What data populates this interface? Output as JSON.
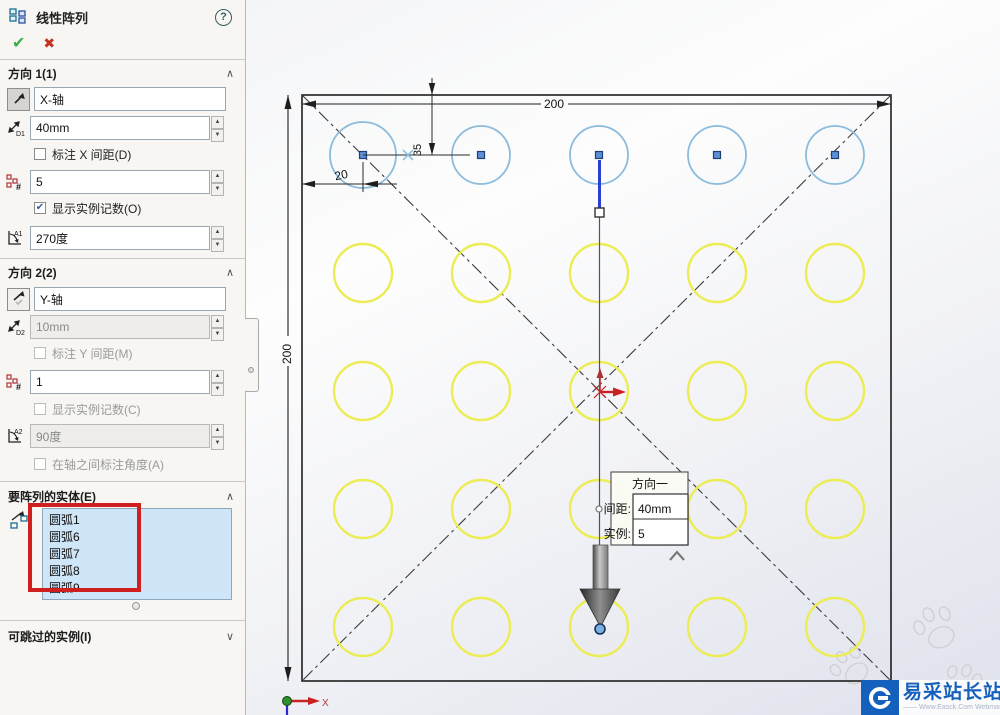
{
  "panel": {
    "title": "线性阵列",
    "help_label": "?",
    "direction1": {
      "header": "方向 1(1)",
      "axis_value": "X-轴",
      "spacing_value": "40mm",
      "dim_spacing_label": "标注 X 间距(D)",
      "instances_value": "5",
      "show_count_label": "显示实例记数(O)",
      "angle_value": "270度"
    },
    "direction2": {
      "header": "方向 2(2)",
      "axis_value": "Y-轴",
      "spacing_value": "10mm",
      "dim_spacing_label": "标注 Y 间距(M)",
      "instances_value": "1",
      "show_count_label": "显示实例记数(C)",
      "angle_value": "90度",
      "angle_between_label": "在轴之间标注角度(A)"
    },
    "entities": {
      "header": "要阵列的实体(E)",
      "items": [
        "圆弧1",
        "圆弧6",
        "圆弧7",
        "圆弧8",
        "圆弧9"
      ]
    },
    "skip": {
      "header": "可跳过的实例(I)"
    }
  },
  "drawing": {
    "dim_top": "200",
    "dim_left": "200",
    "dim_offset_x": "20",
    "dim_offset_y": "35",
    "axis_label": "X",
    "callout": {
      "title": "方向一",
      "spacing_label": "间距:",
      "spacing_value": "40mm",
      "instances_label": "实例:",
      "instances_value": "5"
    },
    "pattern": {
      "cols": 5,
      "rows": 5,
      "origin_x": 363,
      "origin_y": 155,
      "spacing": 118,
      "radius": 29,
      "first_radius": 33,
      "row1_color": "#8cbcdc",
      "other_color": "#ecec55"
    }
  },
  "watermark": {
    "site": "易采站长站",
    "subtitle": "—— Www.Easck.Com Webmaster"
  },
  "colors": {
    "accent_blue": "#1460bc",
    "annotation_red": "#cf1f1f",
    "list_bg": "#cfe5f8",
    "pattern_blue": "#2a3fd4"
  }
}
